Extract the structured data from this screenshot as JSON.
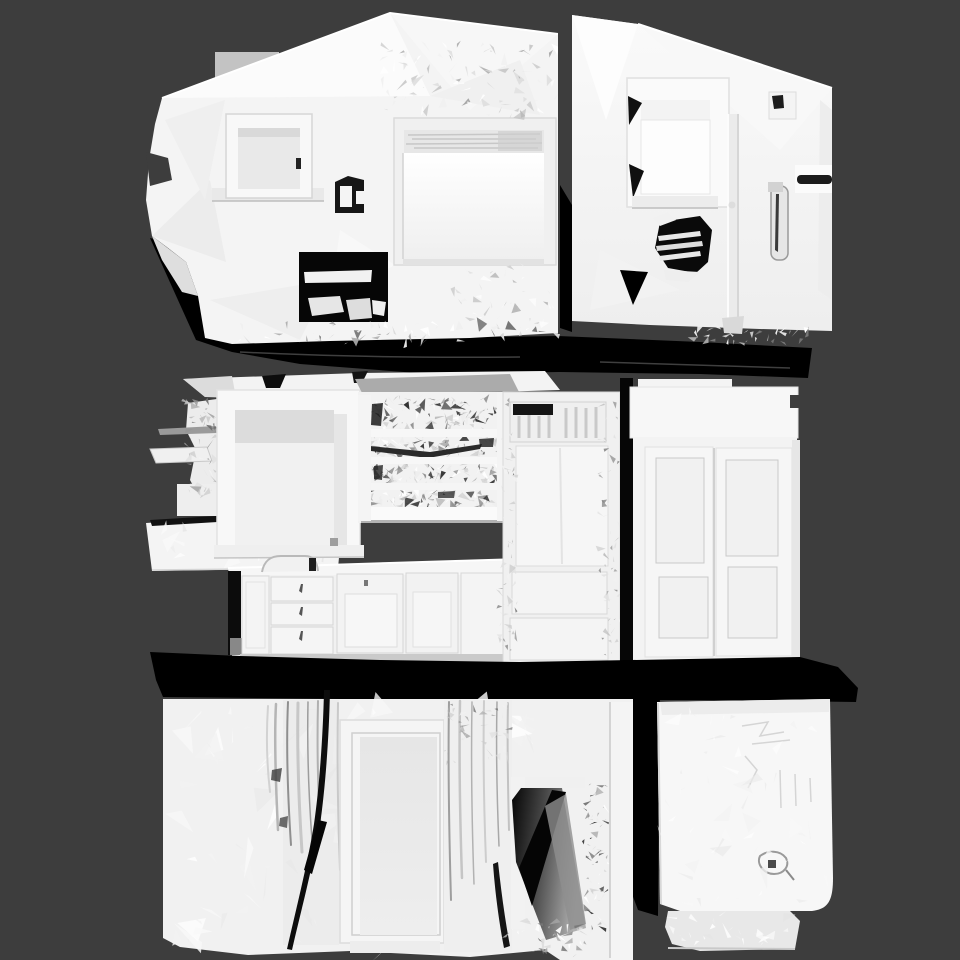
{
  "viewport": {
    "width": 960,
    "height": 960,
    "kind": "3d-mesh-render"
  },
  "colors": {
    "background": "#3d3d3d",
    "mesh_base": "#f2f2f2",
    "mesh_bright": "#ffffff",
    "mesh_shade": "#d8d8d8",
    "shadow": "#000000",
    "recess_gray": "#9a9a9a"
  },
  "scene": {
    "description": "Untextured white photogrammetry mesh of a three-storey building interior, orthographic front view on dark gray background",
    "sections": [
      {
        "id": "top",
        "label": "attic floor: pitched roof wall, small window, large bright panel, tilted right wall with recessed window and handle"
      },
      {
        "id": "middle",
        "label": "kitchen floor: window with ledge, cluttered open shelving, counter with drawers and cabinet doors, refrigerator unit, two-door wardrobe"
      },
      {
        "id": "bottom",
        "label": "ground floor: rough scanned wall with crevice, interior door, dark doorway opening, white appliance box with pedestal"
      }
    ]
  }
}
